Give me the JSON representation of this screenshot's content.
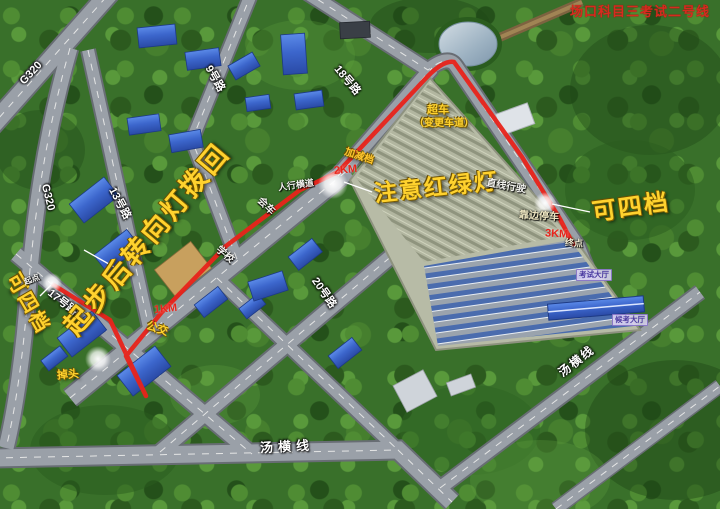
{
  "title": "场口科目三考试二号线",
  "colors": {
    "annotation_yellow": "#ffd22e",
    "route_red": "#e8231a",
    "km_red": "#e8251c",
    "road_label_white": "#ffffff",
    "title_red": "#d62b1f",
    "hall_purple": "#4a3aa0",
    "forest_green": "#39702a",
    "road_gray": "#9aa0a8"
  },
  "road_labels": {
    "g320_nw": "G320",
    "g320_w": "G320",
    "road9": "9号路",
    "road13": "13号路",
    "road17": "17号路",
    "road18": "18号路",
    "road20": "20号路",
    "tangheng_bottom": "汤横线",
    "tangheng_right": "汤横线"
  },
  "annotations": {
    "turn_signal_note": "起步后转向灯拨回",
    "traffic_light_note": "注意红绿灯",
    "gear4_right": "可四档",
    "gear4_left": "可四档"
  },
  "maneuvers": {
    "overtake": "超车",
    "lane_change": "（变更车道）",
    "straight_drive": "直线行驶",
    "pull_over": "靠边停车",
    "crosswalk": "人行横道",
    "meet_vehicle": "会车",
    "school": "学校",
    "bus": "公交",
    "u_turn": "掉头",
    "gear_shift": "加减档"
  },
  "distance_markers": {
    "km1": "1KM",
    "km2": "2KM",
    "km3": "3KM"
  },
  "route_points": {
    "start": "起点",
    "end": "终点"
  },
  "buildings": {
    "exam_hall": "考试大厅",
    "waiting_hall": "候考大厅"
  }
}
